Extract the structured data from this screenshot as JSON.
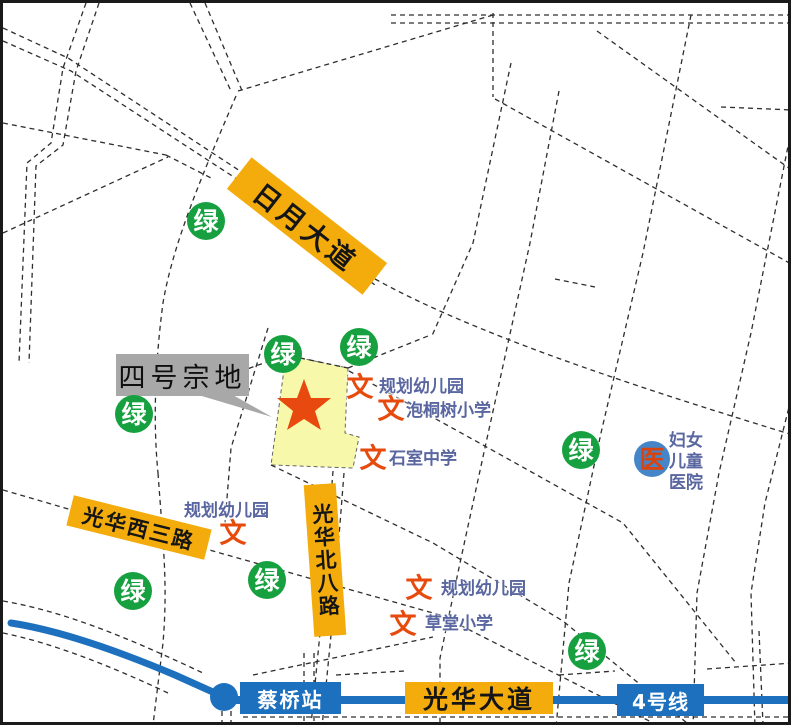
{
  "parcel_callout": {
    "text": "四号宗地"
  },
  "markers": {
    "green_glyph": "绿",
    "education_glyph": "文",
    "hospital_glyph": "医"
  },
  "road_labels": {
    "riyue_avenue": "日月大道",
    "guanghua_west_3rd_road": "光华西三路",
    "guanghua_north_8th_road": "光华北八路",
    "guanghua_avenue": "光华大道"
  },
  "metro": {
    "station_name": "蔡桥站",
    "line_name": "4号线"
  },
  "pois": [
    {
      "name": "规划幼儿园"
    },
    {
      "name": "泡桐树小学"
    },
    {
      "name": "石室中学"
    },
    {
      "name": "规划幼儿园"
    },
    {
      "name": "规划幼儿园"
    },
    {
      "name": "草堂小学"
    }
  ],
  "hospital": {
    "name": "妇女\n儿童\n医院"
  },
  "colors": {
    "road_label_bg": "#F3AC0C",
    "metro_blue": "#1D70BD",
    "green_space": "#17A03F",
    "education_red": "#E64A0C",
    "poi_text_blue": "#5966A0",
    "hospital_circle_blue": "#4586C8",
    "parcel_fill": "#F8F8AA",
    "star_red": "#E8490F",
    "callout_gray": "#A8A8A8",
    "road_line": "#2E2E2E"
  }
}
